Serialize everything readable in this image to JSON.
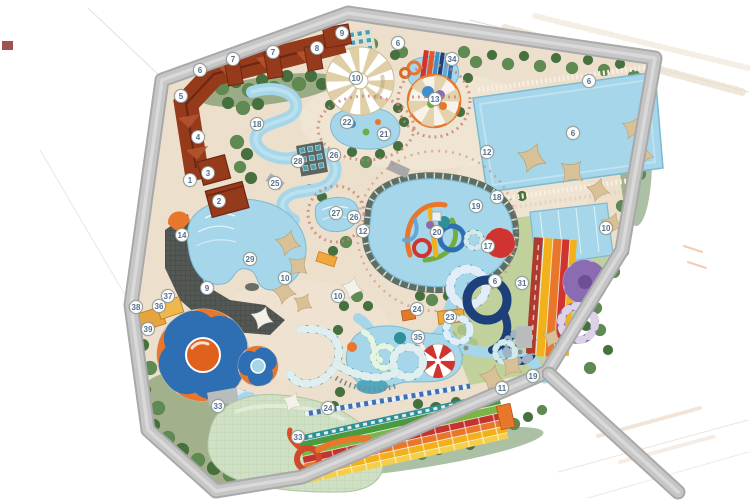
{
  "map": {
    "type": "water-park-master-plan",
    "markers": [
      {
        "n": "1",
        "x": 190,
        "y": 180
      },
      {
        "n": "2",
        "x": 219,
        "y": 201
      },
      {
        "n": "3",
        "x": 208,
        "y": 173
      },
      {
        "n": "4",
        "x": 198,
        "y": 137
      },
      {
        "n": "5",
        "x": 181,
        "y": 96
      },
      {
        "n": "6",
        "x": 200,
        "y": 70
      },
      {
        "n": "7",
        "x": 233,
        "y": 59
      },
      {
        "n": "7",
        "x": 273,
        "y": 52
      },
      {
        "n": "8",
        "x": 317,
        "y": 48
      },
      {
        "n": "9",
        "x": 342,
        "y": 33
      },
      {
        "n": "10",
        "x": 356,
        "y": 78
      },
      {
        "n": "6",
        "x": 398,
        "y": 43
      },
      {
        "n": "34",
        "x": 452,
        "y": 59
      },
      {
        "n": "13",
        "x": 435,
        "y": 99
      },
      {
        "n": "6",
        "x": 589,
        "y": 81
      },
      {
        "n": "6",
        "x": 573,
        "y": 133
      },
      {
        "n": "12",
        "x": 487,
        "y": 152
      },
      {
        "n": "22",
        "x": 347,
        "y": 122
      },
      {
        "n": "21",
        "x": 384,
        "y": 134
      },
      {
        "n": "18",
        "x": 257,
        "y": 124
      },
      {
        "n": "28",
        "x": 298,
        "y": 161
      },
      {
        "n": "26",
        "x": 334,
        "y": 155
      },
      {
        "n": "25",
        "x": 275,
        "y": 183
      },
      {
        "n": "27",
        "x": 336,
        "y": 213
      },
      {
        "n": "26",
        "x": 354,
        "y": 217
      },
      {
        "n": "12",
        "x": 363,
        "y": 231
      },
      {
        "n": "14",
        "x": 182,
        "y": 235
      },
      {
        "n": "29",
        "x": 250,
        "y": 259
      },
      {
        "n": "9",
        "x": 207,
        "y": 288
      },
      {
        "n": "10",
        "x": 285,
        "y": 278
      },
      {
        "n": "10",
        "x": 338,
        "y": 296
      },
      {
        "n": "19",
        "x": 476,
        "y": 206
      },
      {
        "n": "18",
        "x": 497,
        "y": 197
      },
      {
        "n": "20",
        "x": 437,
        "y": 232
      },
      {
        "n": "17",
        "x": 488,
        "y": 246
      },
      {
        "n": "10",
        "x": 606,
        "y": 228
      },
      {
        "n": "6",
        "x": 495,
        "y": 281
      },
      {
        "n": "31",
        "x": 522,
        "y": 283
      },
      {
        "n": "24",
        "x": 417,
        "y": 309
      },
      {
        "n": "23",
        "x": 450,
        "y": 317
      },
      {
        "n": "35",
        "x": 418,
        "y": 337
      },
      {
        "n": "19",
        "x": 533,
        "y": 376
      },
      {
        "n": "11",
        "x": 502,
        "y": 388
      },
      {
        "n": "37",
        "x": 168,
        "y": 296
      },
      {
        "n": "36",
        "x": 159,
        "y": 306
      },
      {
        "n": "38",
        "x": 136,
        "y": 307
      },
      {
        "n": "39",
        "x": 148,
        "y": 329
      },
      {
        "n": "33",
        "x": 218,
        "y": 406
      },
      {
        "n": "24",
        "x": 328,
        "y": 408
      },
      {
        "n": "33",
        "x": 298,
        "y": 437
      }
    ],
    "palette": {
      "sand": "#ecdfcc",
      "road": "#c2c2c2",
      "water": "#a6d6e9",
      "deep_water": "#4fa8c0",
      "green_dark": "#46703e",
      "green_mid": "#5f8a52",
      "green_light": "#7ba268",
      "roof_brown": "#963a1c",
      "roof_ridge": "#6d2812",
      "tent_tan": "#d8c196",
      "slide_orange": "#e8762b",
      "slide_red": "#cf3430",
      "slide_yellow": "#f2b11b",
      "slide_blue": "#2e6fb4",
      "slide_dark_blue": "#1d3f7a",
      "slide_teal": "#2e8f96",
      "slide_green": "#6fae3f",
      "slide_purple": "#8b6bb1",
      "deck_dark": "#545854",
      "dome_green": "#cfe0c4",
      "marker_text": "#55728e"
    }
  }
}
